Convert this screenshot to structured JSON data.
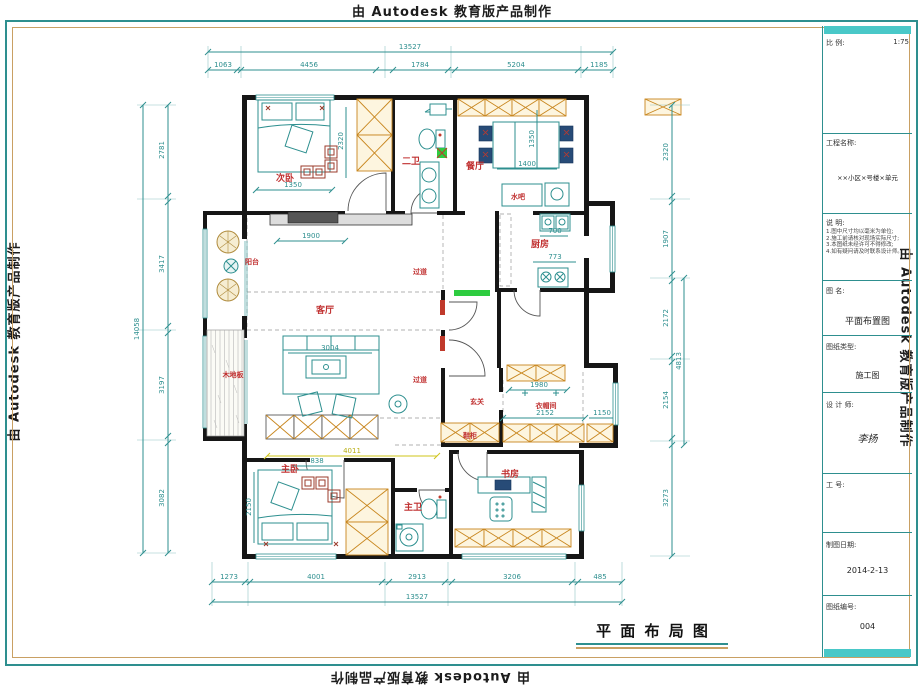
{
  "watermark": {
    "text": "由 Autodesk 教育版产品制作"
  },
  "caption": {
    "text": "平 面 布 局 图"
  },
  "title_block": {
    "scale_label": "比 例:",
    "scale_value": "1:75",
    "project_label": "工程名称:",
    "project_value": "××小区×号楼×单元",
    "notes_label": "说 明:",
    "notes": [
      "1.图中尺寸均以毫米为单位;",
      "2.施工前请核对现场实际尺寸;",
      "3.本图纸未经许可不得修改;",
      "4.如有疑问请及时联系设计师。"
    ],
    "drawing_name_label": "图 名:",
    "drawing_name_value": "平面布置图",
    "drawing_type_label": "图纸类型:",
    "drawing_type_value": "施工图",
    "designer_label": "设 计 师:",
    "designer_value": "李扬",
    "job_no_label": "工 号:",
    "date_label": "制图日期:",
    "date_value": "2014-2-13",
    "sheet_no_label": "图纸编号:",
    "sheet_no_value": "004"
  },
  "rooms": [
    {
      "label": "次卧"
    },
    {
      "label": "二卫"
    },
    {
      "label": "餐厅"
    },
    {
      "label": "水吧"
    },
    {
      "label": "厨房"
    },
    {
      "label": "客厅"
    },
    {
      "label": "过道"
    },
    {
      "label": "过道"
    },
    {
      "label": "阳台"
    },
    {
      "label": "木地板"
    },
    {
      "label": "玄关"
    },
    {
      "label": "鞋柜"
    },
    {
      "label": "衣帽间"
    },
    {
      "label": "主卧"
    },
    {
      "label": "主卫"
    },
    {
      "label": "书房"
    }
  ],
  "dims": {
    "top": {
      "total": "13527",
      "segments": [
        "1063",
        "4456",
        "1784",
        "5204",
        "1185"
      ]
    },
    "bottom": {
      "total": "13527",
      "segments": [
        "1273",
        "4001",
        "2913",
        "3206",
        "485"
      ]
    },
    "left": {
      "total": "14058",
      "segments": [
        "2781",
        "3417",
        "3197",
        "3082"
      ]
    },
    "right": {
      "segments": [
        "2320",
        "1907",
        "2172",
        "2154",
        "3273"
      ],
      "inner_total": "4813"
    },
    "inner": [
      "1350",
      "2320",
      "1350",
      "1400",
      "700",
      "773",
      "1900",
      "3004",
      "4011",
      "838",
      "2150",
      "1980",
      "2152",
      "1150"
    ]
  }
}
